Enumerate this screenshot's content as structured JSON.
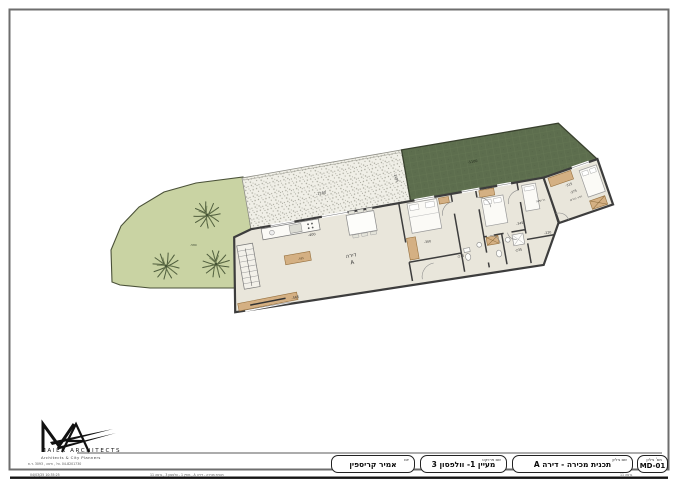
{
  "title_block": {
    "sheet_no_label": "מס' גיליון",
    "sheet_no": "MD-01",
    "sheet_name_label": "שם גיליון",
    "sheet_name": "תכנית מכירה - דירה A",
    "project_label": "שם פרויקט",
    "project": "מעיין 1- וולפסון 3",
    "client_label": "יזם",
    "client": "אמיר קריספין"
  },
  "logo": {
    "name": "MAIER ARCHITECTS",
    "tagline": "Architects & City Planners",
    "contact": "04-8201730 .טל , חיפה , 3093 .ד.ת"
  },
  "footer": {
    "left": "04/03/25  10:35:25",
    "center": "תכנית מכירה - דירה A , מעיין 1 - וולפסון 3 , גרסה 11",
    "right": "גרסה 11"
  },
  "plan": {
    "apartment_label": "דירה",
    "apartment_letter": "A",
    "room_bedroom": "ח' שינה",
    "room_master": "חדר הורים",
    "dims": {
      "garden": "-580",
      "terrace": "-1180",
      "terrace_side": "-2285",
      "roof_garden": "-1100",
      "living_bottom": "-565",
      "kitchen": "-400",
      "island": "-585",
      "bedroom1": "-300",
      "hall": "-345",
      "bath": "-235",
      "bath2": "-275",
      "corridor": "-220",
      "master": "-375",
      "master_side": "-315"
    }
  }
}
